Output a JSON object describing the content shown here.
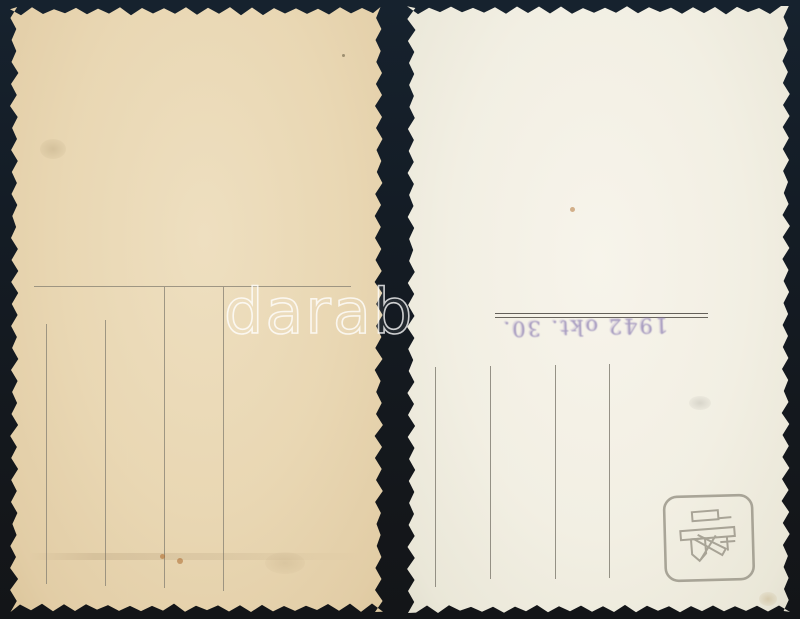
{
  "image": {
    "description": "Two blank vintage photo-postcard backs with deckled (zigzag) edges lying on a dark background",
    "background_color": "#141c25"
  },
  "watermark": {
    "text": "darab",
    "color": "#ffffff"
  },
  "left_postcard": {
    "kind": "blank postcard back",
    "paper_color": "#e9d7b3",
    "ruling": {
      "horizontal_line_count": 1,
      "vertical_line_count": 4,
      "line_color": "#8b8476"
    }
  },
  "right_postcard": {
    "kind": "blank postcard back",
    "paper_color": "#f2efe3",
    "address_rule": {
      "style": "double horizontal line",
      "line_color": "#55514a"
    },
    "date_stamp": {
      "text": "1942 okt. 30.",
      "ink_color": "#8a7cb2",
      "orientation": "upside-down"
    },
    "ruling": {
      "vertical_line_count": 4,
      "line_color": "#7d796e"
    },
    "corner_stamp": {
      "icon": "photo-studio-logo-icon",
      "color": "#8d887b"
    }
  }
}
